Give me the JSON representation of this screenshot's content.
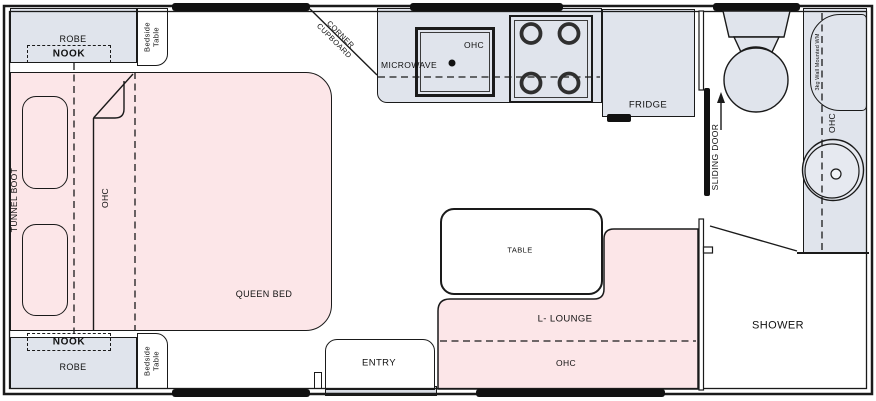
{
  "title": "Caravan floor plan",
  "colors": {
    "pink": "#fce6e8",
    "gray": "#e0e4ec",
    "wall": "#1a1a1a",
    "window": "#111111"
  },
  "plan": {
    "bedroom": {
      "robe": "ROBE",
      "nook": "NOOK",
      "bedside_table": "Bedside Table",
      "tunnel_boot": "TUNNEL BOOT",
      "ohc": "OHC",
      "queen_bed": "QUEEN BED"
    },
    "kitchen": {
      "corner_cupboard": "CORNER CUPBOARD",
      "microwave": "MICROWAVE",
      "ohc": "OHC",
      "fridge": "FRIDGE"
    },
    "bathroom": {
      "sliding_door": "SLIDING DOOR",
      "washing_machine": "3kg Wall Mounted WM",
      "ohc": "OHC",
      "shower": "SHOWER"
    },
    "living": {
      "table": "TABLE",
      "lounge": "L- LOUNGE",
      "ohc": "OHC",
      "entry": "ENTRY"
    }
  }
}
